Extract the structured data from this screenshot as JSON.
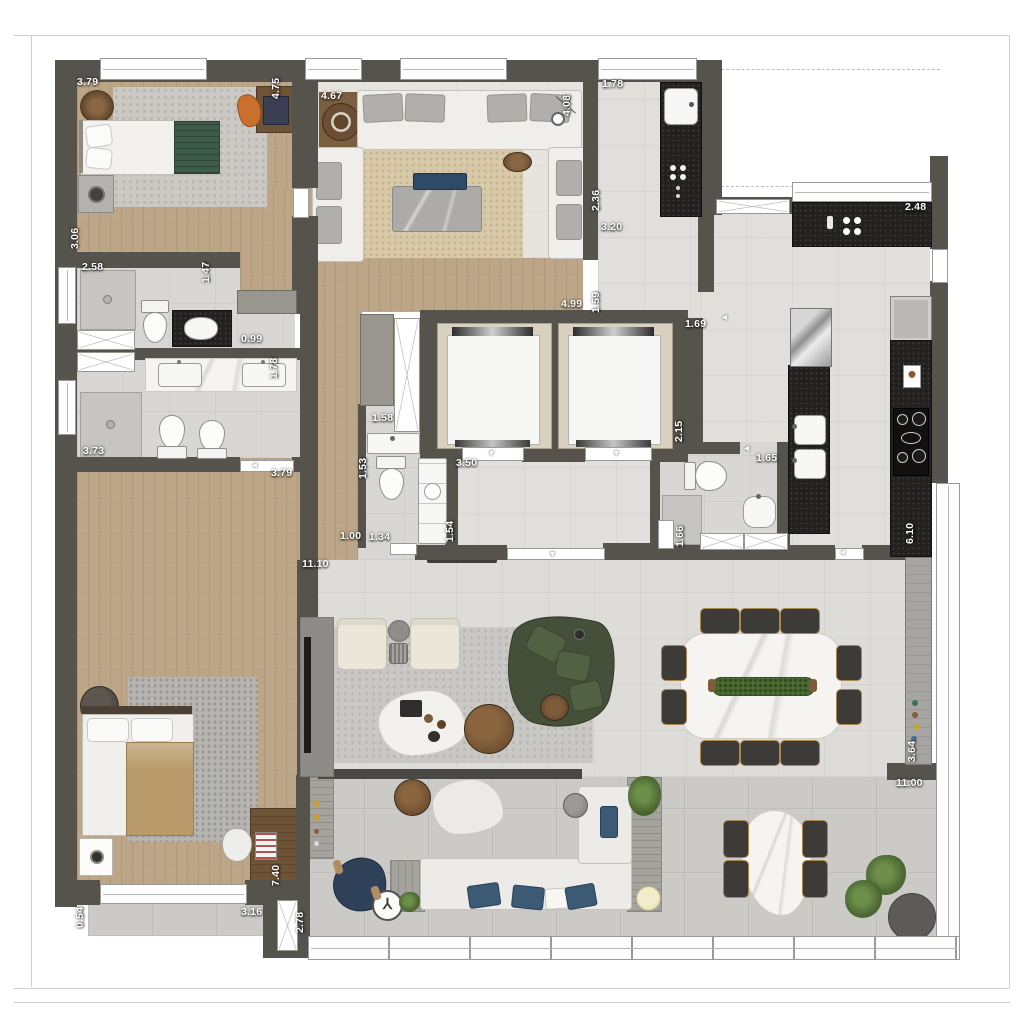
{
  "plan": {
    "name": "apartment-floor-plan-top-view"
  },
  "dims": [
    {
      "t": "3.79"
    },
    {
      "t": "4.75"
    },
    {
      "t": "4.67"
    },
    {
      "t": "4.08"
    },
    {
      "t": "1.78"
    },
    {
      "t": "2.48"
    },
    {
      "t": "2.36"
    },
    {
      "t": "3.20"
    },
    {
      "t": "4.99"
    },
    {
      "t": "1.59"
    },
    {
      "t": "1.69"
    },
    {
      "t": "3.06"
    },
    {
      "t": "2.58"
    },
    {
      "t": "1.47"
    },
    {
      "t": "0.99"
    },
    {
      "t": "1.78"
    },
    {
      "t": "3.73"
    },
    {
      "t": "3.79"
    },
    {
      "t": "1.58"
    },
    {
      "t": "1.53"
    },
    {
      "t": "3.50"
    },
    {
      "t": "1.00"
    },
    {
      "t": "1.34"
    },
    {
      "t": "1.54"
    },
    {
      "t": "11.10"
    },
    {
      "t": "2.15"
    },
    {
      "t": "1.65"
    },
    {
      "t": "1.66"
    },
    {
      "t": "6.10"
    },
    {
      "t": "3.64"
    },
    {
      "t": "11.00"
    },
    {
      "t": "7.40"
    },
    {
      "t": "0.54"
    },
    {
      "t": "3.16"
    },
    {
      "t": "2.78"
    }
  ],
  "colors": {
    "wall": "#56524C",
    "woodFloor": "#BCA687",
    "tile": "#E0DFDB",
    "terraceTile": "#CBCAC6",
    "counterBlack": "#23211F",
    "marble": "#F5F4F1",
    "sofaGreen": "#44503A",
    "navyBlue": "#2E4158",
    "cream": "#EAE6D8",
    "rugBeige": "#D9CAA9",
    "plantGreen": "#4E6B35"
  }
}
